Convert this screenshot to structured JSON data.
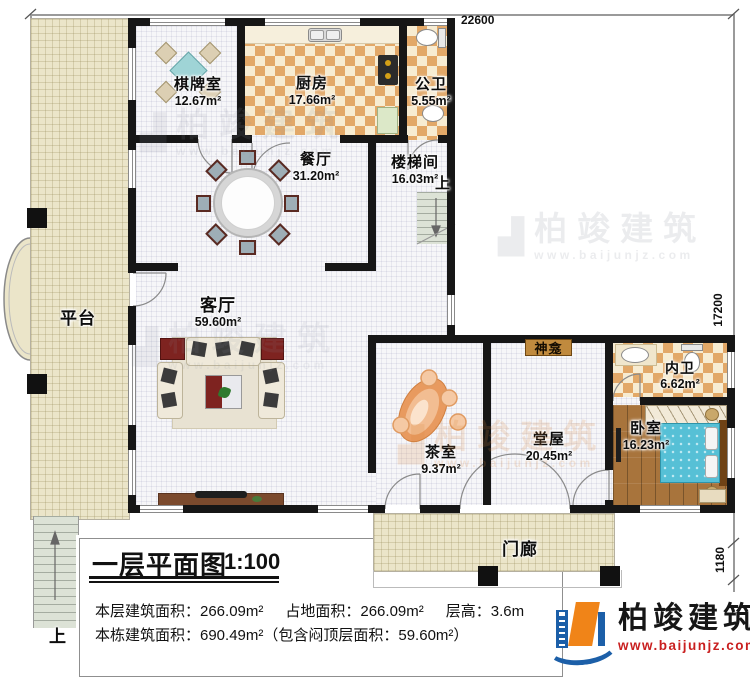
{
  "dims": {
    "top": "22600",
    "right": "17200",
    "porch_depth": "1180"
  },
  "rooms": {
    "chess": {
      "label": "棋牌室",
      "area": "12.67m²"
    },
    "kitchen": {
      "label": "厨房",
      "area": "17.66m²"
    },
    "pub_bath": {
      "label": "公卫",
      "area": "5.55m²"
    },
    "dining": {
      "label": "餐厅",
      "area": "31.20m²"
    },
    "stairwell": {
      "label": "楼梯间",
      "area": "16.03m²",
      "up": "上"
    },
    "living": {
      "label": "客厅",
      "area": "59.60m²"
    },
    "platform": {
      "label": "平台"
    },
    "tea": {
      "label": "茶室",
      "area": "9.37m²"
    },
    "hall": {
      "label": "堂屋",
      "area": "20.45m²"
    },
    "shrine": {
      "label": "神龛"
    },
    "inner_bath": {
      "label": "内卫",
      "area": "6.62m²"
    },
    "bedroom": {
      "label": "卧室",
      "area": "16.23m²"
    },
    "porch": {
      "label": "门廊"
    },
    "ext_stairs": {
      "label": "上"
    }
  },
  "title_block": {
    "title": "一层平面图",
    "scale": "1:100",
    "info1_a": "本层建筑面积：266.09m²",
    "info1_b": "占地面积：266.09m²",
    "info1_c": "层高：3.6m",
    "info2": "本栋建筑面积：690.49m²（包含闷顶层面积：59.60m²）"
  },
  "logo": {
    "name": "柏竣建筑",
    "url": "www.baijunjz.com"
  },
  "watermark": {
    "name": "柏竣建筑",
    "url": "www.baijunjz.com",
    "glyph": "▟"
  },
  "colors": {
    "wall": "#161616",
    "checker": "#e2a868",
    "platform": "#ebe5c9",
    "wood": "#a8743c",
    "logo_blue": "#1c5fa8",
    "logo_orange": "#f08418",
    "logo_red": "#c91f1f"
  }
}
